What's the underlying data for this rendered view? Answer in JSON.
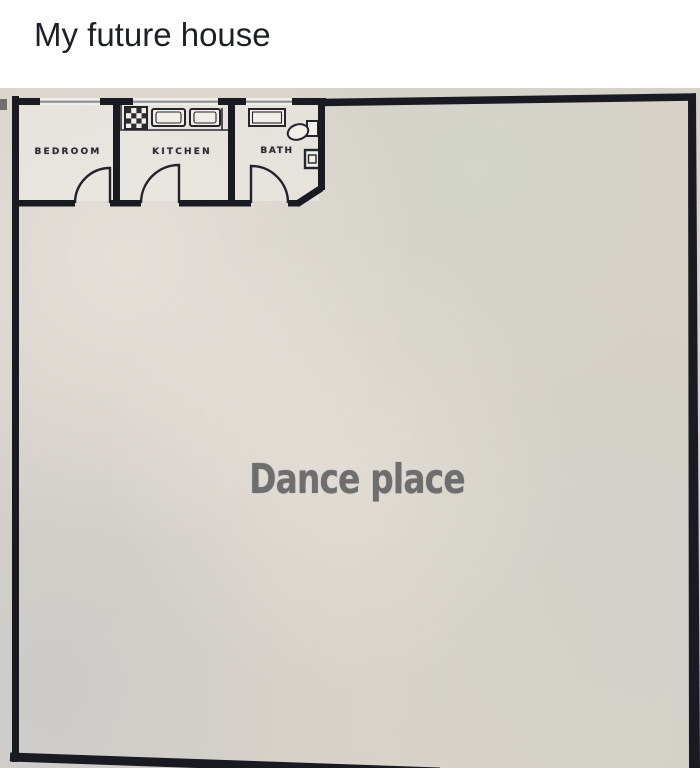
{
  "caption": {
    "text": "My future house",
    "color": "#1d2126",
    "background": "#ffffff"
  },
  "floorplan": {
    "background_color": "#d6d1c9",
    "wall_color": "#1a1a22",
    "window_color": "#8f8f93",
    "fixture_fill": "#f1efe8",
    "labels": {
      "bedroom": "BEDROOM",
      "kitchen": "KITCHEN",
      "bath": "BATH",
      "dance": "Dance place"
    },
    "dance_text_color": "#6e6e6e",
    "fixture_icons": [
      "stove-icon",
      "kitchen-sink-icon",
      "bath-sink-icon",
      "toilet-icon",
      "shower-drain-icon",
      "door-arc-icon"
    ]
  }
}
